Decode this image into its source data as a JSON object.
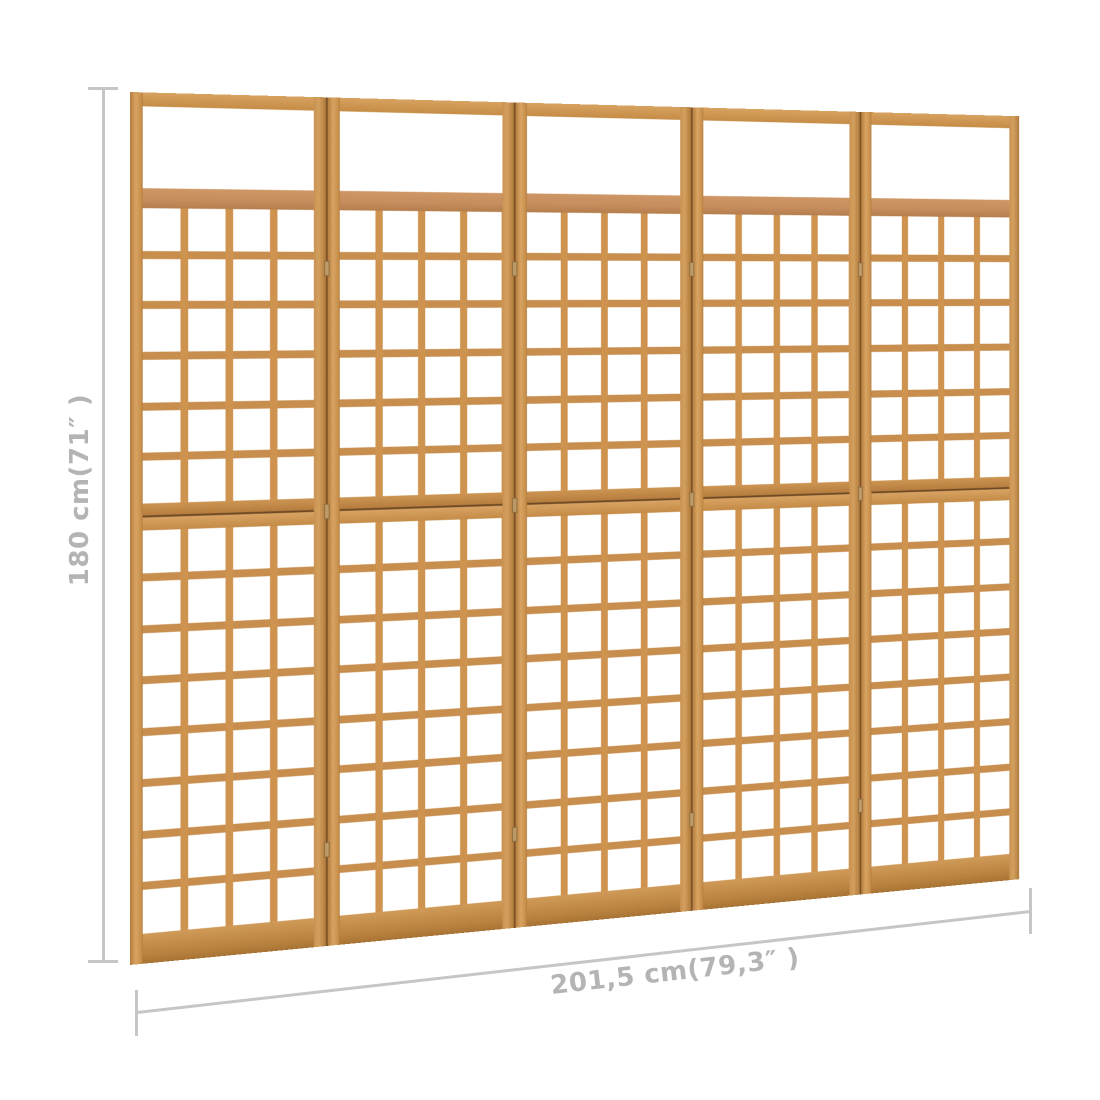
{
  "product_view": {
    "description": "5-panel wooden trellis room divider shown front-on with slight right-receding perspective",
    "panel_count": 5,
    "panel_structure": {
      "top_open_window": true,
      "lattice_columns_per_panel": 4,
      "lattice_rows_upper_section": 6,
      "lattice_rows_lower_section": 8,
      "hinge_marks_per_joint": 3
    }
  },
  "dimensions": {
    "height_label": "180 cm(71″ )",
    "width_label": "201,5 cm(79,3″ )"
  },
  "colors": {
    "wood": "#cf9350",
    "wood_light": "#dca565",
    "wood_dark": "#ab7138",
    "wood_slat_h": "#c78e4e",
    "rail_pink": "#c58c5c",
    "gap_dark": "#7c5226",
    "dim_line": "#c6c6c6",
    "dim_text": "#b4b4b4",
    "bg": "#ffffff"
  }
}
